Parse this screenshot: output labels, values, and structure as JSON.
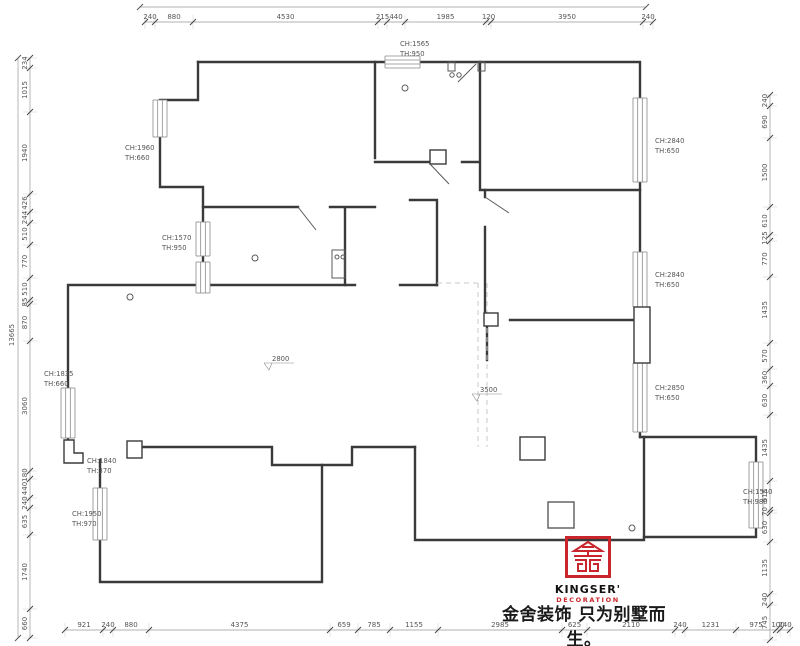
{
  "dimensions": {
    "top": [
      "240",
      "880",
      "4530",
      "215",
      "440",
      "1985",
      "120",
      "3950",
      "240"
    ],
    "bottom": [
      "921",
      "240",
      "880",
      "4375",
      "659",
      "785",
      "1155",
      "2985",
      "625",
      "2110",
      "240",
      "1231",
      "975",
      "100",
      "240"
    ],
    "left": [
      "234",
      "1015",
      "1940",
      "426",
      "244",
      "510",
      "770",
      "510",
      "85",
      "870",
      "3060",
      "180",
      "440",
      "240",
      "635",
      "1740",
      "660"
    ],
    "right": [
      "240",
      "690",
      "1500",
      "610",
      "125",
      "770",
      "1435",
      "570",
      "360",
      "630",
      "1435",
      "615",
      "70",
      "630",
      "1135",
      "240",
      "745"
    ],
    "left_total": "13665"
  },
  "room_labels": [
    {
      "ch": "CH:1565",
      "th": "TH:950",
      "x": 400,
      "y": 46
    },
    {
      "ch": "CH:1960",
      "th": "TH:660",
      "x": 125,
      "y": 150
    },
    {
      "ch": "CH:1570",
      "th": "TH:950",
      "x": 162,
      "y": 240
    },
    {
      "ch": "CH:2840",
      "th": "TH:650",
      "x": 655,
      "y": 143
    },
    {
      "ch": "CH:2840",
      "th": "TH:650",
      "x": 655,
      "y": 277
    },
    {
      "ch": "CH:2850",
      "th": "TH:650",
      "x": 655,
      "y": 390
    },
    {
      "ch": "CH:1835",
      "th": "TH:660",
      "x": 44,
      "y": 376
    },
    {
      "ch": "CH:1840",
      "th": "TH:370",
      "x": 87,
      "y": 463
    },
    {
      "ch": "CH:1950",
      "th": "TH:970",
      "x": 72,
      "y": 516
    },
    {
      "ch": "CH:1540",
      "th": "TH:980",
      "x": 743,
      "y": 494
    }
  ],
  "level_markers": [
    {
      "value": "2800",
      "x": 270,
      "y": 361
    },
    {
      "value": "3500",
      "x": 478,
      "y": 392
    }
  ],
  "logo": {
    "brand": "KINGSER'",
    "sub": "DECORATION",
    "tagline": "金舍装饰 只为别墅而生。",
    "accent_color": "#c9252c"
  },
  "colors": {
    "wall": "#3a3a3a",
    "dimension": "#8a8a8a",
    "label": "#555555",
    "dashed": "#c9c9c9"
  }
}
